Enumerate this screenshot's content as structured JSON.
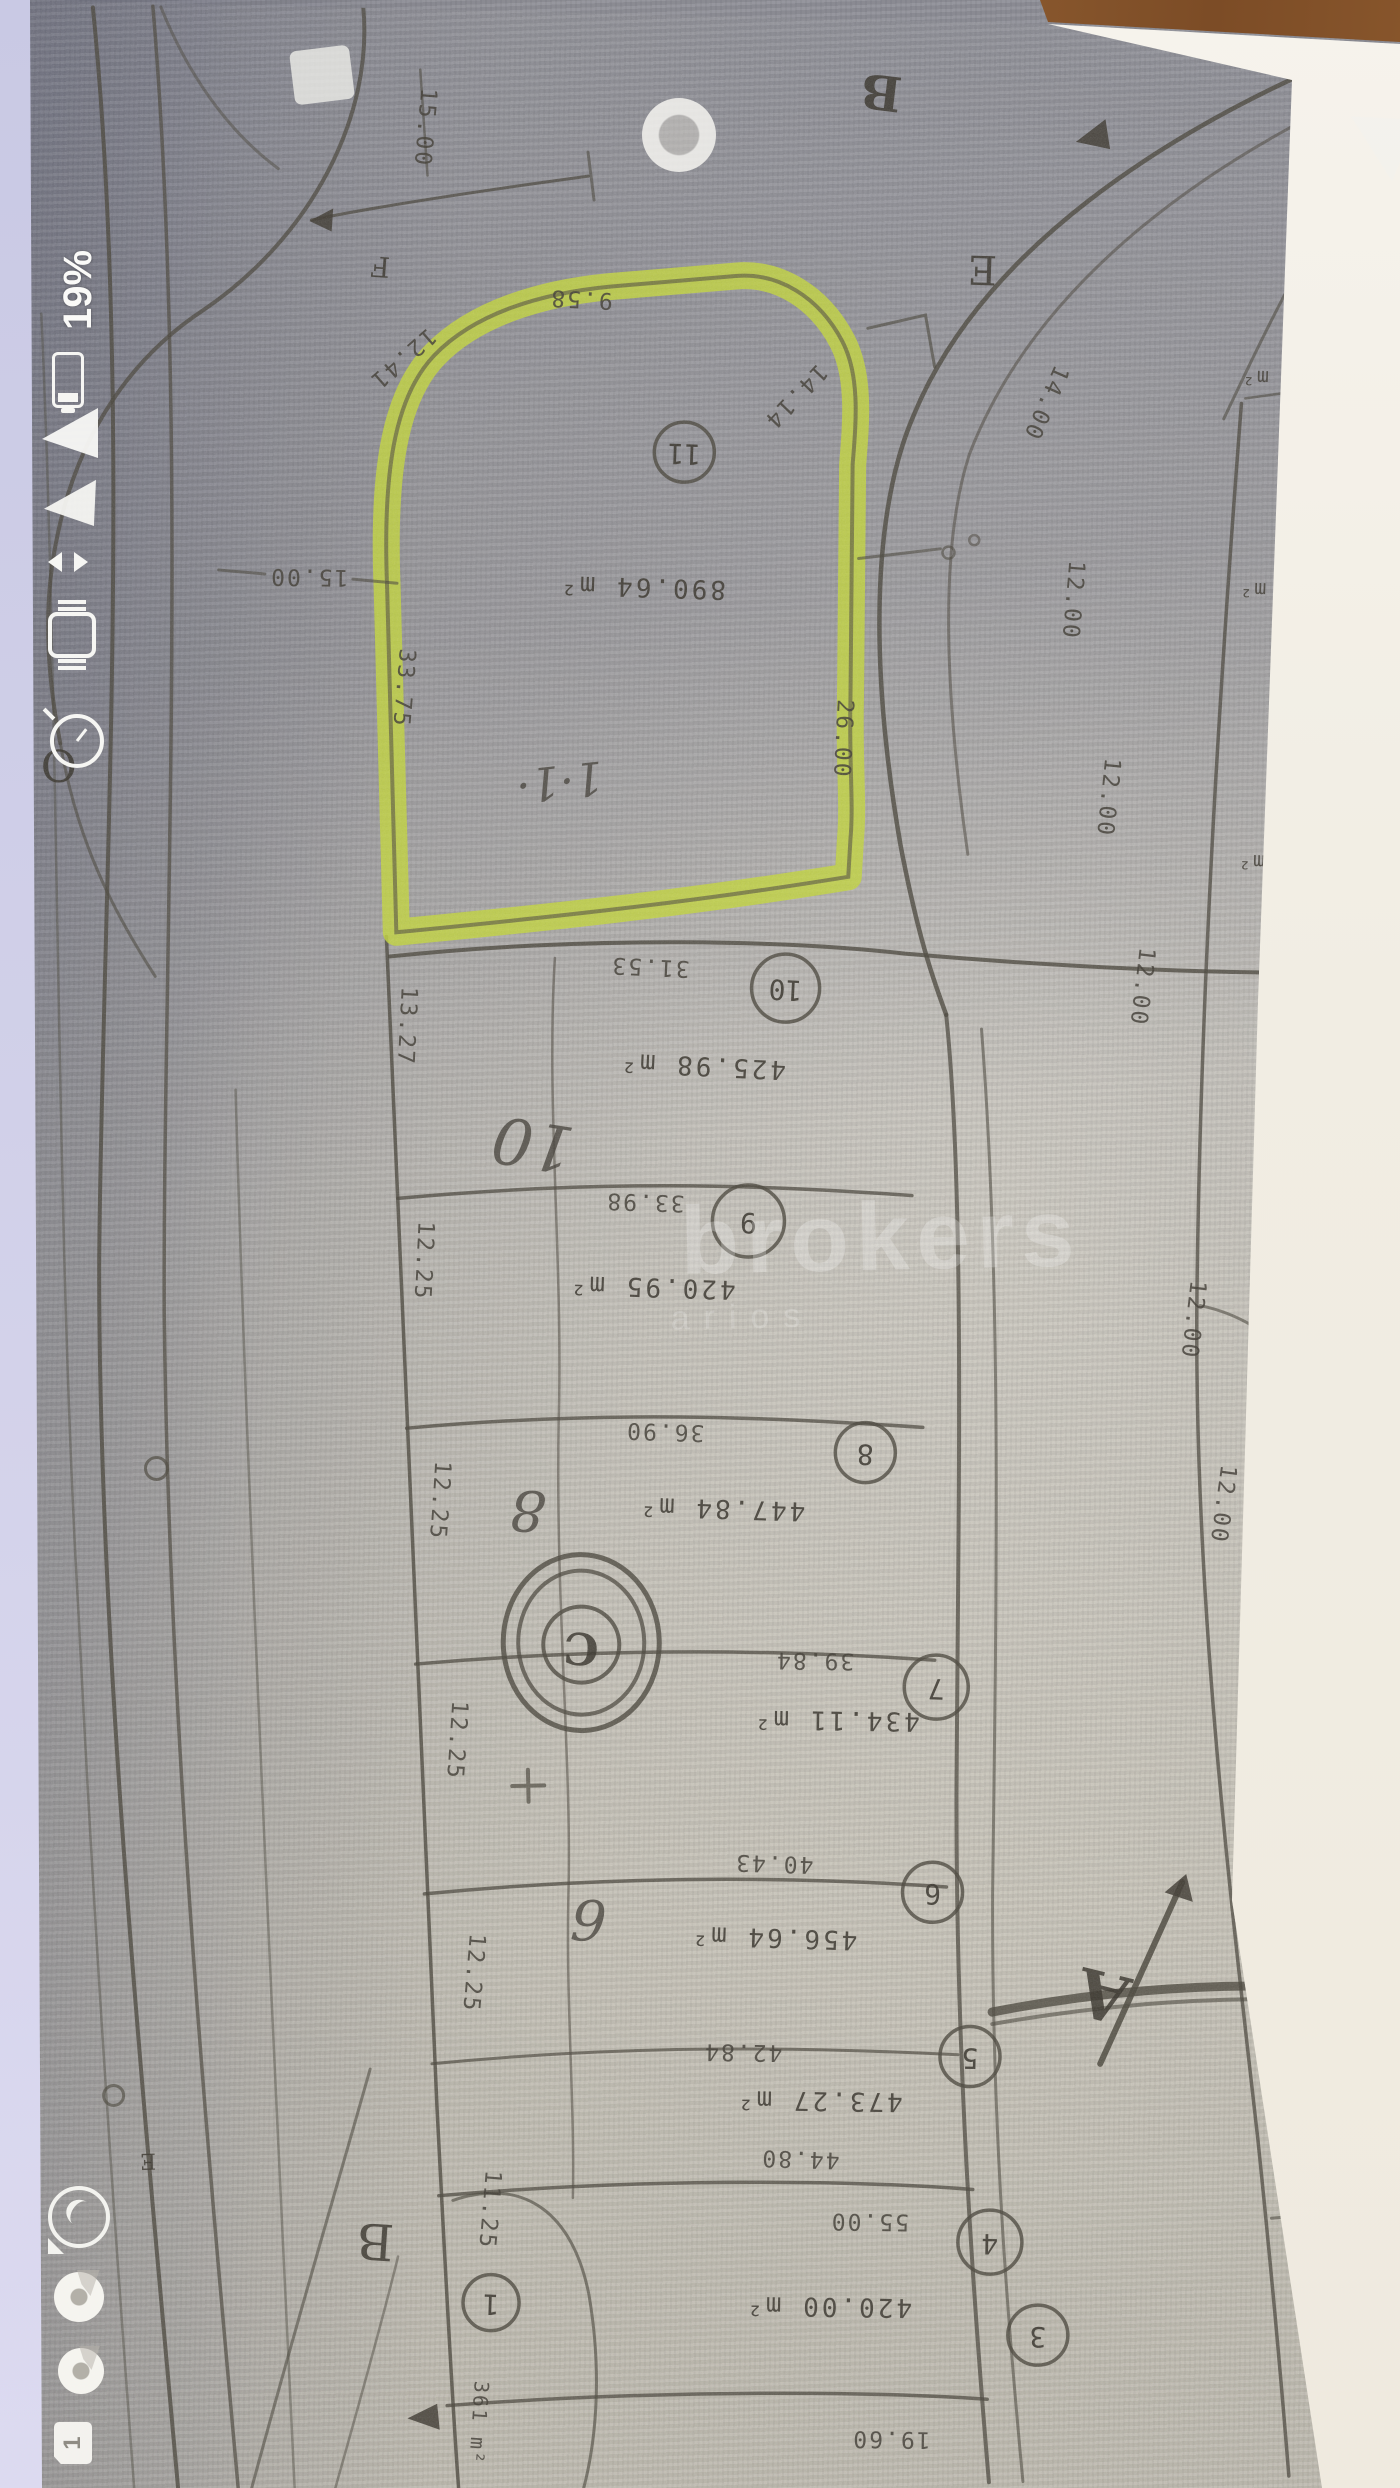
{
  "status_bar": {
    "battery_percent": "19%",
    "indicator_icons": [
      "battery-icon",
      "signal-wedge-icon",
      "signal-wedge-icon",
      "vibrate-icon",
      "smartwatch-icon",
      "alarm-clock-icon"
    ],
    "notification_icons": [
      "whatsapp-icon",
      "chrome-icon",
      "chrome-icon",
      "sim-card-icon"
    ],
    "sim_badge": "1"
  },
  "nav_bar": {
    "icons": [
      "recents-square-icon",
      "home-circle-icon",
      "back-triangle-icon"
    ]
  },
  "watermark": {
    "line1": "brokers",
    "line2": "arios"
  },
  "map": {
    "highlight_color": "#c3d63d",
    "highlighted_lot": {
      "number": "11",
      "area": "890.64 m²",
      "note": "1·1·"
    },
    "lot_numbers": [
      "11",
      "10",
      "9",
      "8",
      "7",
      "6",
      "5",
      "4",
      "3",
      "1"
    ],
    "areas": [
      "890.64 m²",
      "425.98 m²",
      "420.95 m²",
      "447.84 m²",
      "434.11 m²",
      "456.64 m²",
      "473.27 m²",
      "420.00 m²",
      "361 m²"
    ],
    "frontage_dims": [
      "31.53",
      "33.98",
      "36.90",
      "39.84",
      "40.43",
      "42.84",
      "44.80",
      "55.00",
      "19.60"
    ],
    "left_dims": [
      "13.27",
      "12.25",
      "12.25",
      "12.25",
      "12.25",
      "11.25"
    ],
    "right_dims": [
      "12.00",
      "12.00",
      "12.00",
      "12.00",
      "12.00",
      "12.00",
      "12.10"
    ],
    "top_dims": {
      "v": "15.00",
      "h": "15.00",
      "r": "14.00"
    },
    "edge_dims": {
      "d1": "12.41",
      "d2": "9.58",
      "d3": "14.14",
      "d4": "33.75",
      "d5": "26.00"
    },
    "letters": {
      "f": "F",
      "b_top": "B",
      "e_right": "E",
      "o_left": "O",
      "b_bottom": "B",
      "e_bottom": "E",
      "a": "A",
      "c": "C"
    },
    "handwritten": {
      "note": "1·1·",
      "ten": "10",
      "eight": "8",
      "six": "6"
    },
    "m2_fragments": [
      "m²",
      "m²",
      "m²",
      "m²"
    ]
  }
}
